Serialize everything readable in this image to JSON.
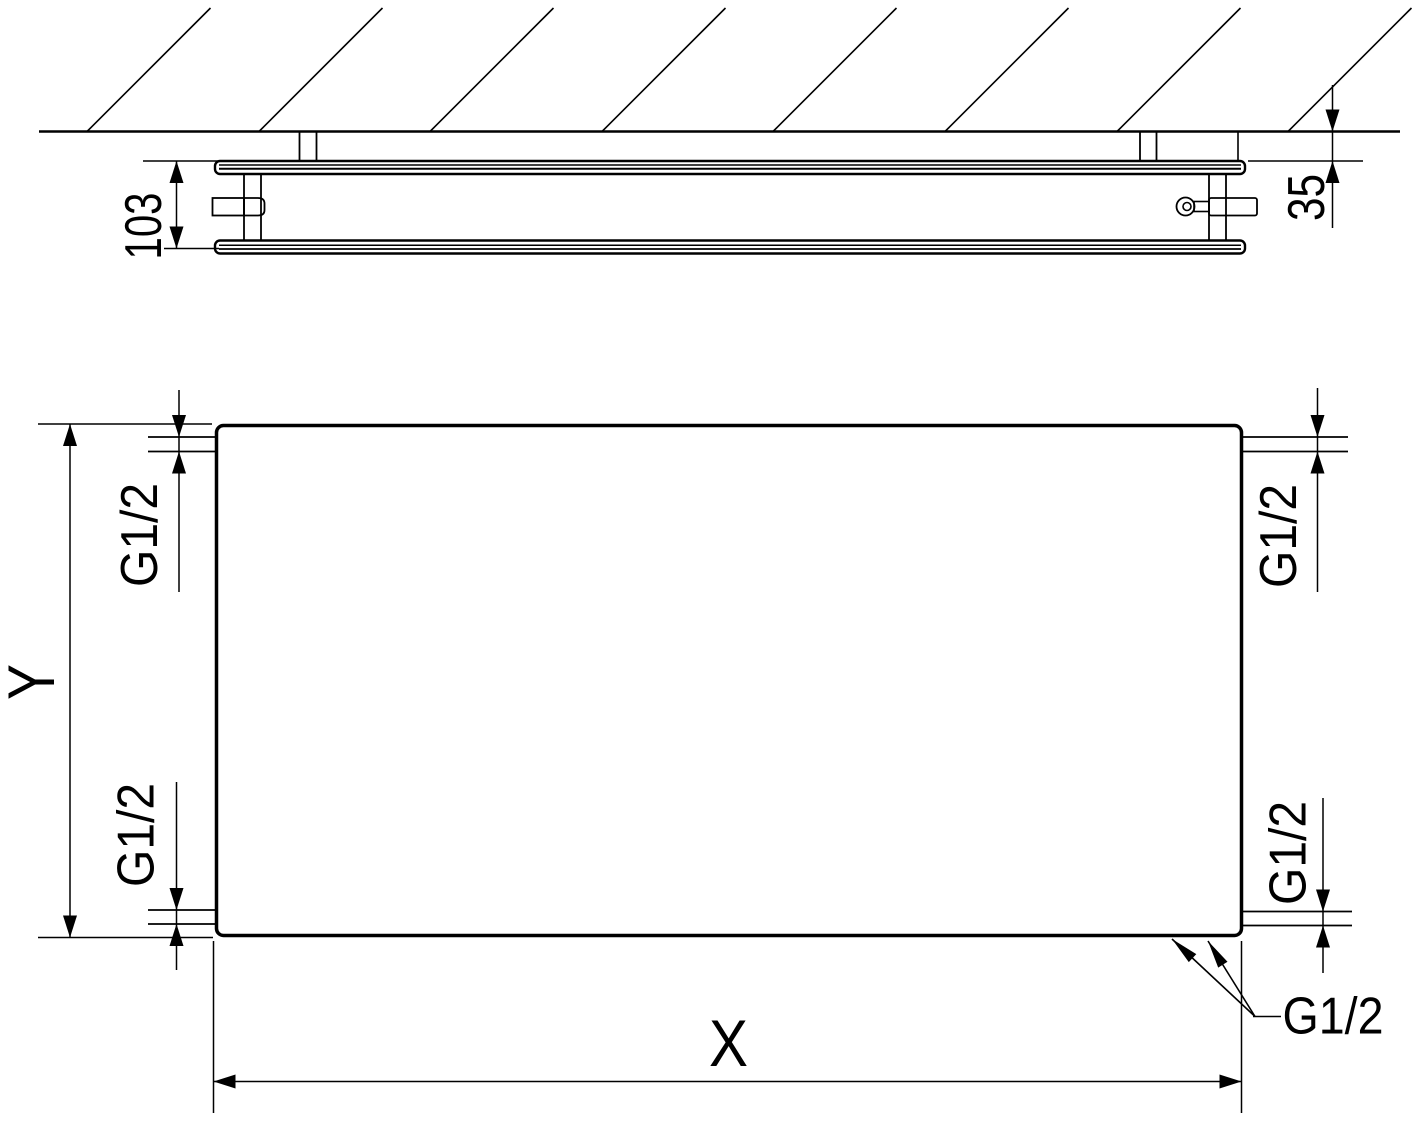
{
  "colors": {
    "background": "#ffffff",
    "line": "#000000",
    "text": "#000000"
  },
  "section_view": {
    "depth_dimension": "103",
    "wall_distance_dimension": "35"
  },
  "front_view": {
    "height_dimension": "Y",
    "width_dimension": "X",
    "ports": {
      "top_left": "G1/2",
      "top_right": "G1/2",
      "bottom_left": "G1/2",
      "bottom_right": "G1/2"
    },
    "bottom_connection_callout": "G1/2"
  }
}
